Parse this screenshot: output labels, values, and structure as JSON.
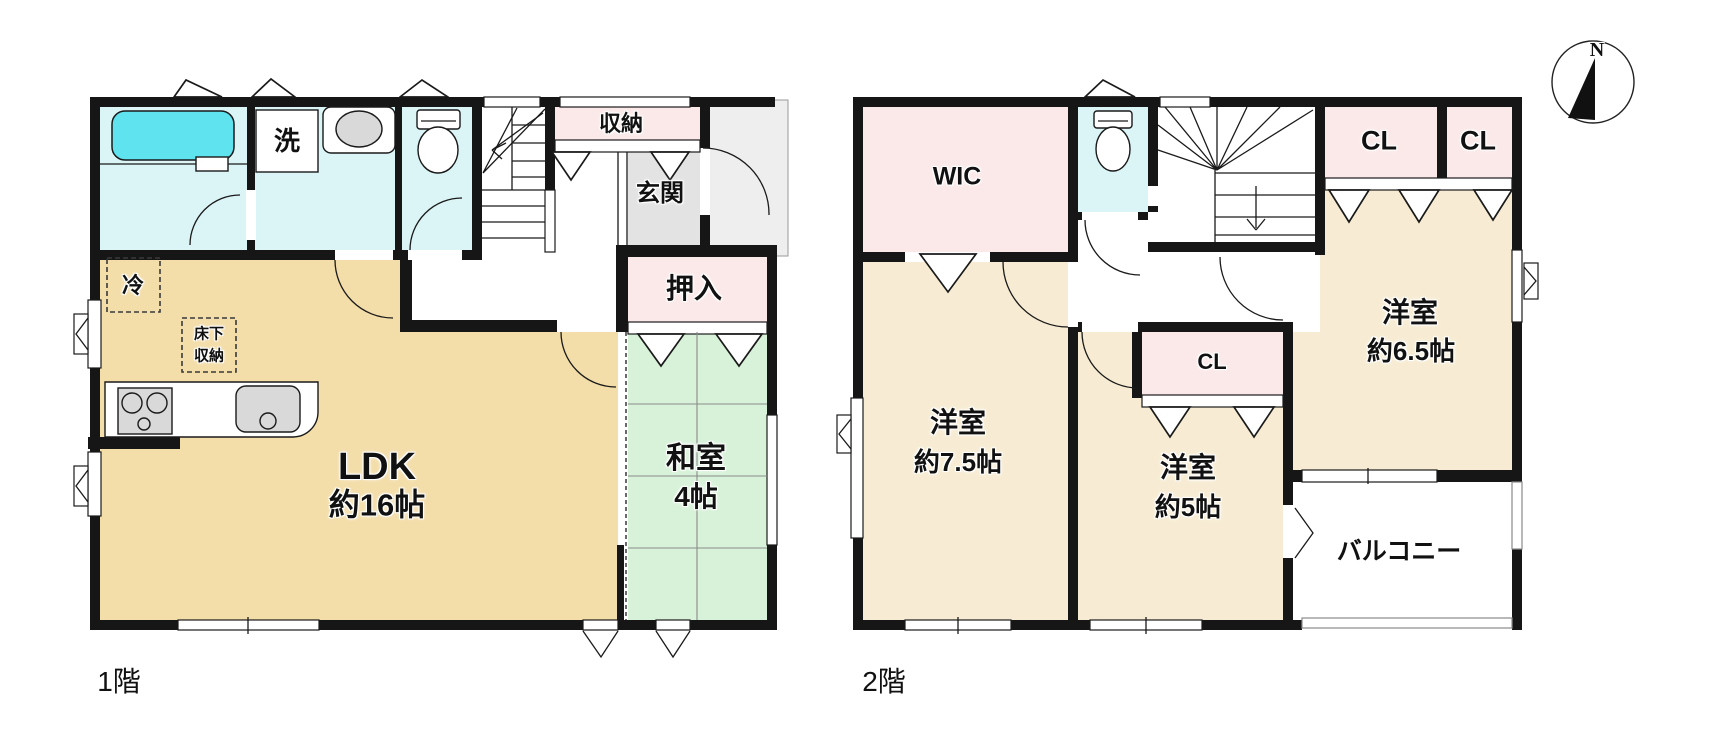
{
  "palette": {
    "wall": "#161616",
    "cream1": "#f3dda9",
    "cream2": "#f7ecd3",
    "pink": "#fbe9e9",
    "cyan": "#dbf4f6",
    "tub": "#5fe3ee",
    "tatami": "#d8f2d9",
    "genkan": "#e3e3e3",
    "porch": "#eeeeee"
  },
  "floor1": {
    "label": "1階",
    "ldk": {
      "name": "LDK",
      "size": "約16帖"
    },
    "washitsu": {
      "name": "和室",
      "size": "4帖"
    },
    "oshiire": "押入",
    "genkan": "玄関",
    "shunou": "収納",
    "laundry": "洗",
    "fridge": "冷",
    "underfloor": {
      "line1": "床下",
      "line2": "収納"
    }
  },
  "floor2": {
    "label": "2階",
    "wic": "WIC",
    "closet1": "CL",
    "closet2": "CL",
    "closet3": "CL",
    "room75": {
      "name": "洋室",
      "size": "約7.5帖"
    },
    "room5": {
      "name": "洋室",
      "size": "約5帖"
    },
    "room65": {
      "name": "洋室",
      "size": "約6.5帖"
    },
    "balcony": "バルコニー"
  },
  "compass": {
    "north": "N"
  }
}
